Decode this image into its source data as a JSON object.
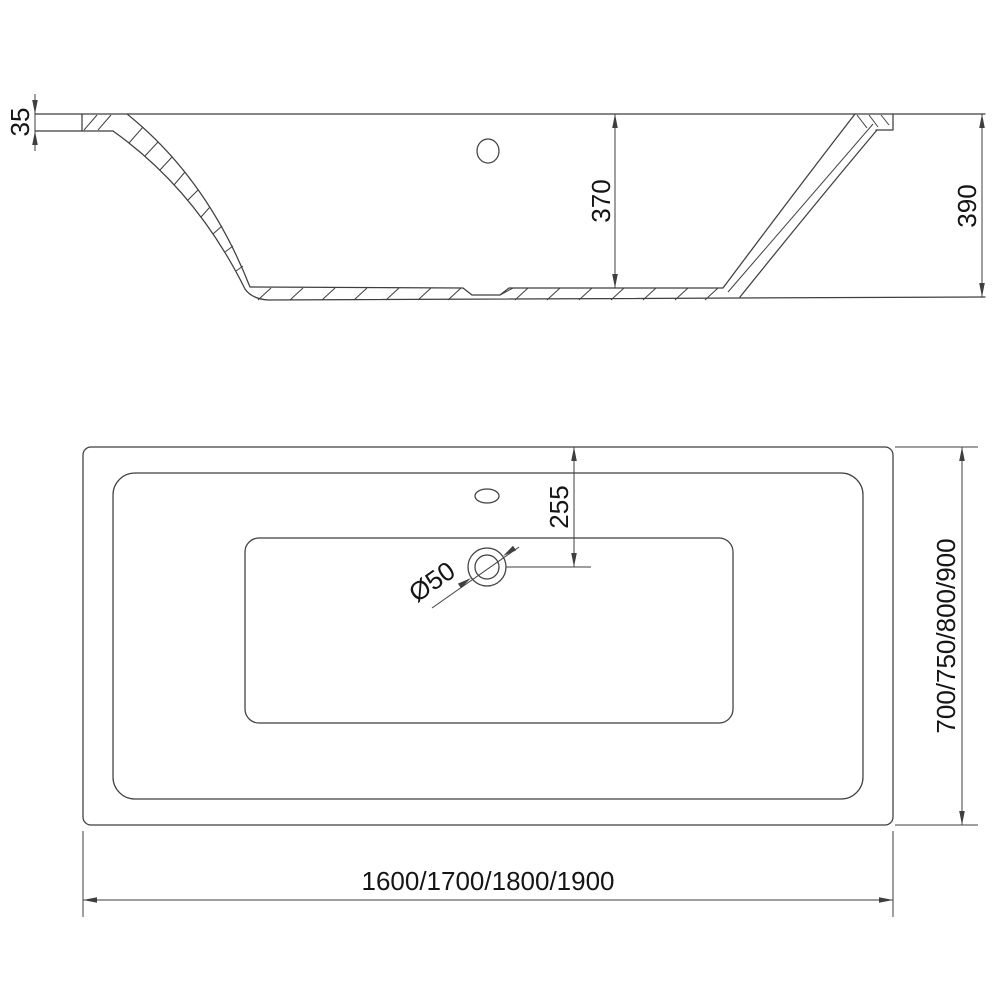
{
  "colors": {
    "line": "#3f3f41",
    "text": "#151515",
    "background": "#ffffff"
  },
  "views": {
    "side": {
      "dimensions": {
        "rim_thickness": "35",
        "inner_depth": "370",
        "overall_height": "390"
      }
    },
    "plan": {
      "dimensions": {
        "drain_offset": "255",
        "drain_diameter": "Ø50",
        "overall_length": "1600/1700/1800/1900",
        "overall_width": "700/750/800/900"
      }
    }
  }
}
